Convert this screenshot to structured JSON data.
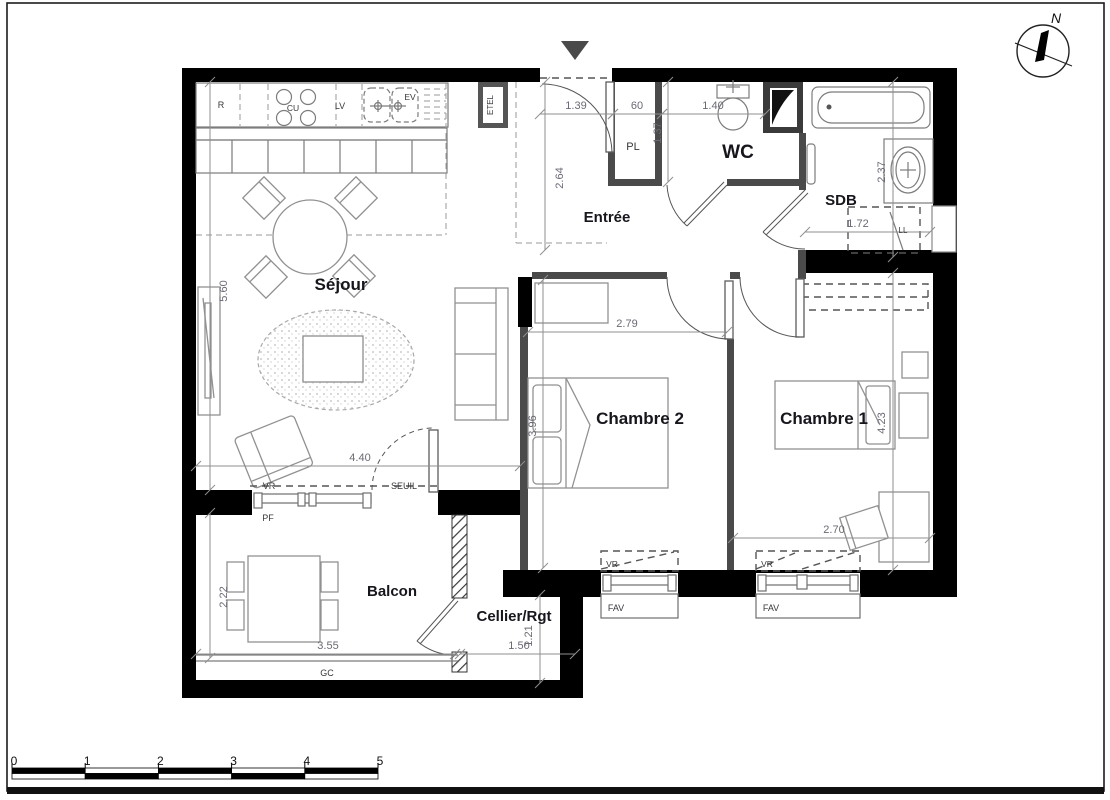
{
  "rooms": [
    {
      "id": "sejour",
      "label": "Séjour",
      "x": 341,
      "y": 290,
      "fs": 17
    },
    {
      "id": "entree",
      "label": "Entrée",
      "x": 607,
      "y": 222,
      "fs": 15
    },
    {
      "id": "wc",
      "label": "WC",
      "x": 738,
      "y": 158,
      "fs": 19
    },
    {
      "id": "sdb",
      "label": "SDB",
      "x": 841,
      "y": 205,
      "fs": 15
    },
    {
      "id": "chambre2",
      "label": "Chambre 2",
      "x": 640,
      "y": 424,
      "fs": 17
    },
    {
      "id": "chambre1",
      "label": "Chambre 1",
      "x": 824,
      "y": 424,
      "fs": 17
    },
    {
      "id": "balcon",
      "label": "Balcon",
      "x": 392,
      "y": 596,
      "fs": 15
    },
    {
      "id": "cellier",
      "label": "Cellier/Rgt",
      "x": 514,
      "y": 621,
      "fs": 15
    }
  ],
  "annotations": [
    {
      "id": "refrigerator",
      "label": "R",
      "x": 221,
      "y": 108,
      "fs": 9,
      "rot": 0
    },
    {
      "id": "cooktop",
      "label": "CU",
      "x": 293,
      "y": 111,
      "fs": 8.5,
      "rot": 0
    },
    {
      "id": "dishwasher",
      "label": "LV",
      "x": 340,
      "y": 109,
      "fs": 9,
      "rot": 0
    },
    {
      "id": "sink",
      "label": "EV",
      "x": 410,
      "y": 100,
      "fs": 8.5,
      "rot": 0
    },
    {
      "id": "etel",
      "label": "ETEL",
      "x": 493,
      "y": 105,
      "fs": 8,
      "rot": -90
    },
    {
      "id": "closet",
      "label": "PL",
      "x": 633,
      "y": 150,
      "fs": 11,
      "rot": 0
    },
    {
      "id": "washer",
      "label": "LL",
      "x": 903,
      "y": 233,
      "fs": 8,
      "rot": 0
    },
    {
      "id": "vr-sejour",
      "label": "VR",
      "x": 269,
      "y": 489,
      "fs": 9,
      "rot": 0
    },
    {
      "id": "seuil",
      "label": "SEUIL",
      "x": 404,
      "y": 489,
      "fs": 9,
      "rot": 0
    },
    {
      "id": "pf",
      "label": "PF",
      "x": 268,
      "y": 521,
      "fs": 9,
      "rot": 0
    },
    {
      "id": "vr-ch2",
      "label": "VR",
      "x": 612,
      "y": 567,
      "fs": 8.5,
      "rot": 0
    },
    {
      "id": "fav-ch2",
      "label": "FAV",
      "x": 616,
      "y": 611,
      "fs": 9,
      "rot": 0
    },
    {
      "id": "vr-ch1",
      "label": "VR",
      "x": 767,
      "y": 567,
      "fs": 8.5,
      "rot": 0
    },
    {
      "id": "fav-ch1",
      "label": "FAV",
      "x": 771,
      "y": 611,
      "fs": 9,
      "rot": 0
    },
    {
      "id": "gc",
      "label": "GC",
      "x": 327,
      "y": 676,
      "fs": 9,
      "rot": 0
    }
  ],
  "dimensions": [
    {
      "label": "1.39",
      "x1": 540,
      "y1": 114,
      "x2": 613,
      "y2": 114,
      "lx": 576,
      "ly": 109,
      "vert": false
    },
    {
      "label": "60",
      "x1": 613,
      "y1": 114,
      "x2": 662,
      "y2": 114,
      "lx": 637,
      "ly": 109,
      "vert": false
    },
    {
      "label": "1.40",
      "x1": 662,
      "y1": 114,
      "x2": 765,
      "y2": 114,
      "lx": 713,
      "ly": 109,
      "vert": false
    },
    {
      "label": "1.37",
      "x1": 668,
      "y1": 82,
      "x2": 668,
      "y2": 182,
      "lx": 661,
      "ly": 133,
      "vert": true
    },
    {
      "label": "2.64",
      "x1": 545,
      "y1": 82,
      "x2": 545,
      "y2": 250,
      "lx": 563,
      "ly": 178,
      "vert": true
    },
    {
      "label": "2.37",
      "x1": 893,
      "y1": 82,
      "x2": 893,
      "y2": 257,
      "lx": 885,
      "ly": 172,
      "vert": true
    },
    {
      "label": "1.72",
      "x1": 805,
      "y1": 232,
      "x2": 930,
      "y2": 232,
      "lx": 858,
      "ly": 227,
      "vert": false
    },
    {
      "label": "5.60",
      "x1": 210,
      "y1": 82,
      "x2": 210,
      "y2": 490,
      "lx": 227,
      "ly": 291,
      "vert": true
    },
    {
      "label": "4.40",
      "x1": 196,
      "y1": 466,
      "x2": 520,
      "y2": 466,
      "lx": 360,
      "ly": 461,
      "vert": false
    },
    {
      "label": "2.79",
      "x1": 528,
      "y1": 332,
      "x2": 727,
      "y2": 332,
      "lx": 627,
      "ly": 327,
      "vert": false
    },
    {
      "label": "3.96",
      "x1": 543,
      "y1": 280,
      "x2": 543,
      "y2": 568,
      "lx": 536,
      "ly": 426,
      "vert": true
    },
    {
      "label": "4.23",
      "x1": 893,
      "y1": 273,
      "x2": 893,
      "y2": 570,
      "lx": 885,
      "ly": 423,
      "vert": true
    },
    {
      "label": "2.70",
      "x1": 733,
      "y1": 538,
      "x2": 930,
      "y2": 538,
      "lx": 834,
      "ly": 533,
      "vert": false
    },
    {
      "label": "2.22",
      "x1": 210,
      "y1": 513,
      "x2": 210,
      "y2": 658,
      "lx": 227,
      "ly": 597,
      "vert": true
    },
    {
      "label": "3.55",
      "x1": 196,
      "y1": 654,
      "x2": 455,
      "y2": 654,
      "lx": 328,
      "ly": 649,
      "vert": false
    },
    {
      "label": "1.50",
      "x1": 460,
      "y1": 654,
      "x2": 575,
      "y2": 654,
      "lx": 519,
      "ly": 649,
      "vert": false
    },
    {
      "label": "1.21",
      "x1": 540,
      "y1": 595,
      "x2": 540,
      "y2": 683,
      "lx": 532,
      "ly": 636,
      "vert": true
    }
  ],
  "compass": {
    "north_label": "N"
  },
  "scale_bar": {
    "tick_labels": [
      "0",
      "1",
      "2",
      "3",
      "4",
      "5"
    ]
  },
  "colors": {
    "wall": "#000000",
    "interior_wall": "#4a4a4a",
    "dim_line": "#8f8f8f",
    "dim_text": "#6a6a74",
    "room_text": "#16161c",
    "annotation_text": "#38383c",
    "entrance_marker": "#4a4a4a"
  }
}
